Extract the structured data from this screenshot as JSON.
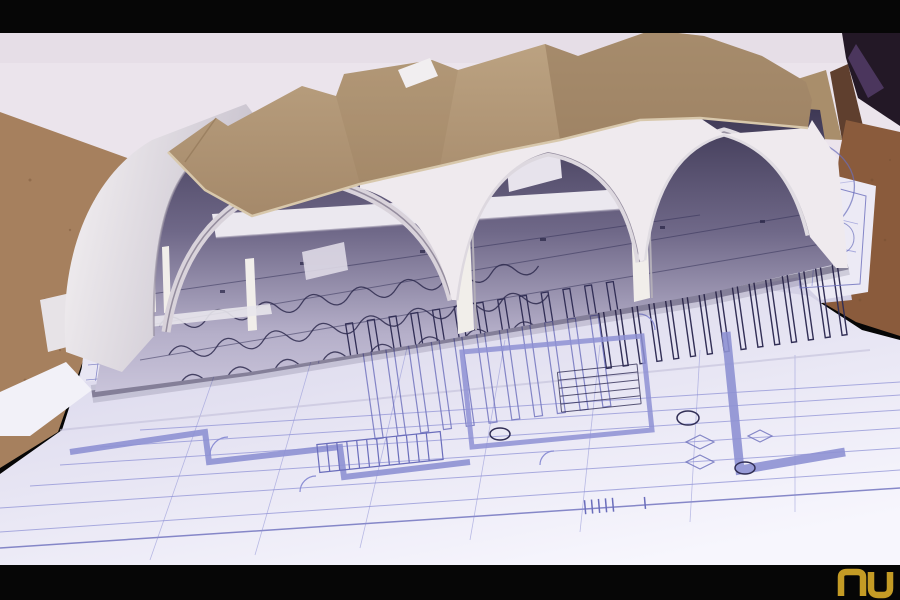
{
  "scene": {
    "type": "photograph",
    "description": "Letterboxed slide photograph of an architectural cardboard study model with three white barrel-vault shells and a corrugated cardboard roof, standing over large floor-plan blueprints (violet-blue ink on white paper) spread across a brown cork table. A small gold NU monogram watermark sits in the lower-right black bar.",
    "subject": "church vault study model on blueprints",
    "letterbox_top_px": 33,
    "letterbox_bottom_px": 35
  },
  "watermark": {
    "text": "NU"
  },
  "palette": {
    "letterbox": "#060606",
    "wall": "#ebe4ec",
    "wall_shade": "#ddd5df",
    "cork_left": "#a6805e",
    "cork_right": "#8a5b3c",
    "cork_pink": "#b3786a",
    "dark_corner": "#231826",
    "purple_streak": "#5a4070",
    "cardboard_scrap": "#a98e6b",
    "scrap_dark": "#5f3f2e",
    "roof_light": "#bda483",
    "roof_dark": "#8f7455",
    "roof_edge": "#d8c8ac",
    "shell_light": "#efeaee",
    "shell_shade": "#c7c1cd",
    "column_white": "#f1eeea",
    "interior_dark": "#3a3450",
    "interior_mid": "#6f6888",
    "floor_lavender": "#c9c4da",
    "paper_shade": "#d6d3e9",
    "paper_bright": "#f7f6fd",
    "paper_back": "#d4d1e6",
    "line_violet": "#8b8ed4",
    "line_violet_strong": "#6a6dbb",
    "line_navy": "#312e55",
    "line_wall": "#8e91d3",
    "gold": "#c49b25"
  }
}
